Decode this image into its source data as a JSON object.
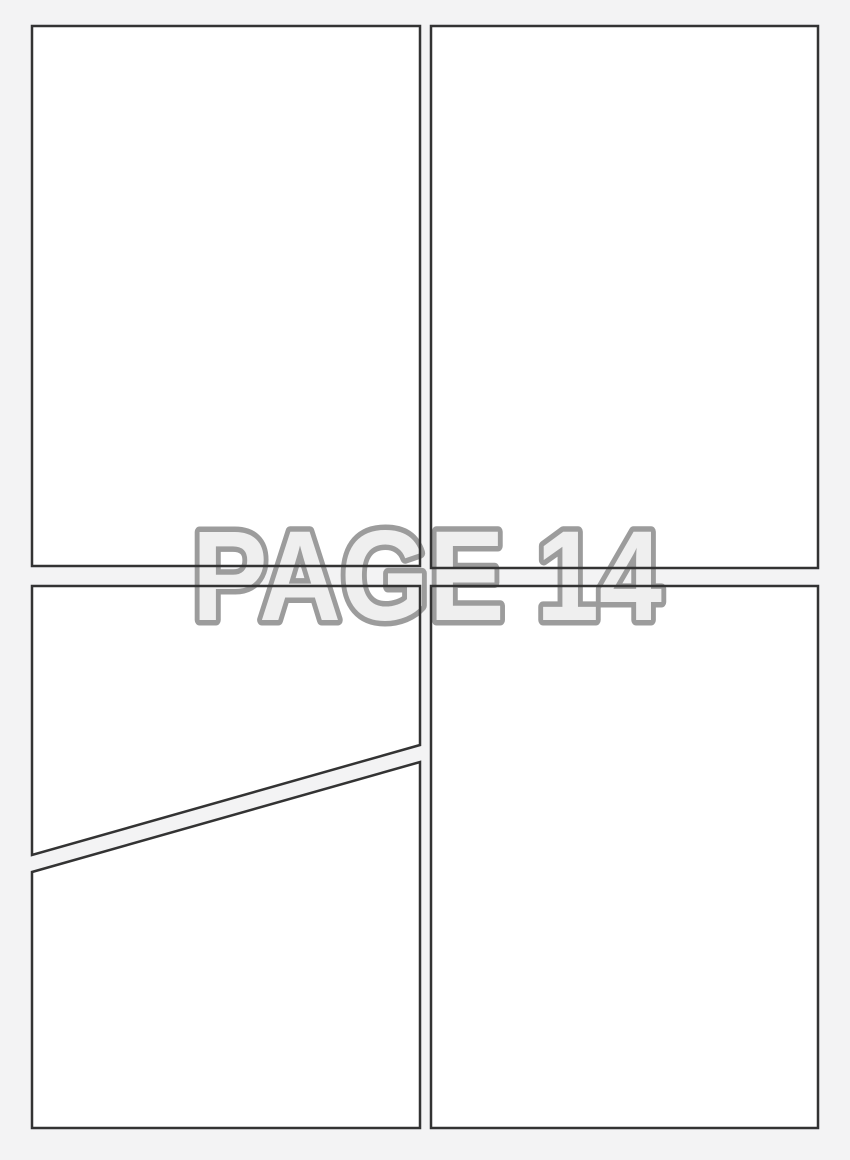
{
  "page": {
    "watermark_label": "PAGE 14",
    "colors": {
      "background": "#f3f3f4",
      "panel_fill": "#ffffff",
      "panel_border": "#333333",
      "watermark_fill": "#efefef",
      "watermark_outline": "#9c9c9c"
    },
    "panels": [
      {
        "id": "top-left",
        "shape": "rectangle"
      },
      {
        "id": "top-right",
        "shape": "rectangle"
      },
      {
        "id": "bottom-left-upper",
        "shape": "diagonal-cut"
      },
      {
        "id": "bottom-left-lower",
        "shape": "diagonal-cut"
      },
      {
        "id": "bottom-right",
        "shape": "rectangle"
      }
    ]
  }
}
